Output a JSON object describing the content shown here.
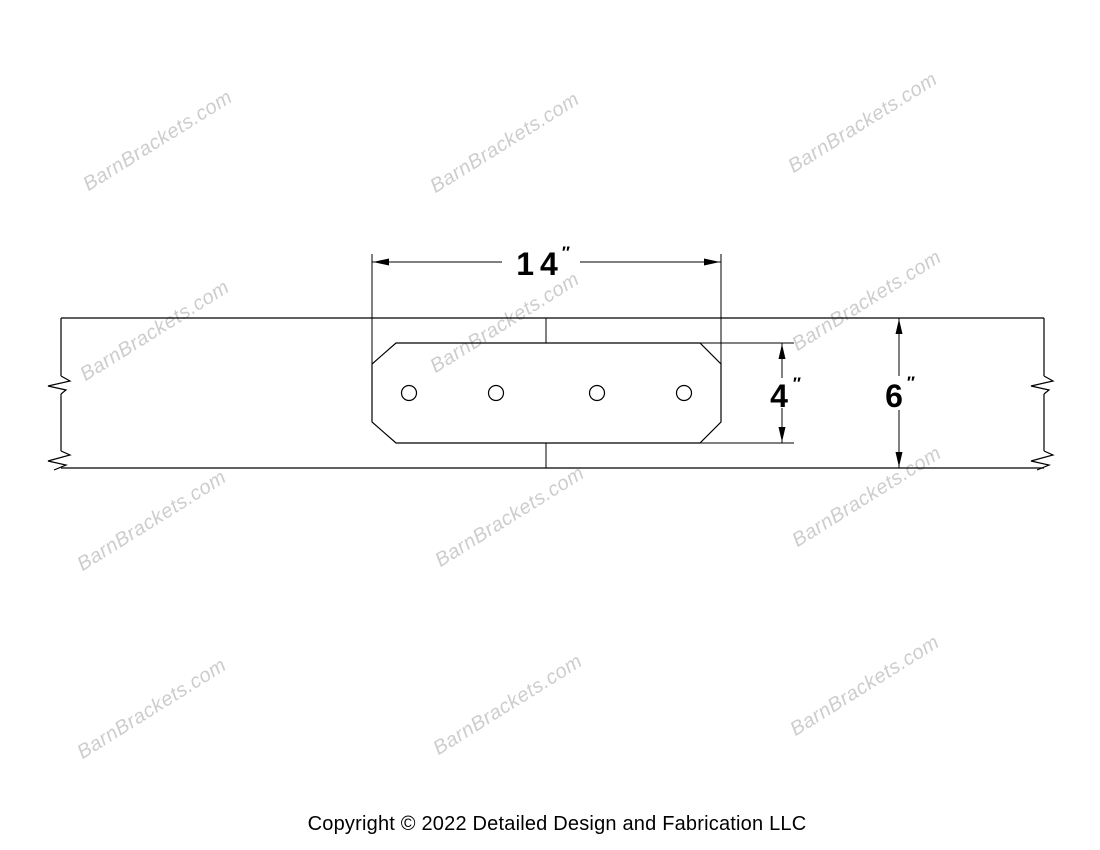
{
  "page": {
    "background": "#ffffff",
    "line_color": "#000000"
  },
  "watermark": {
    "text": "BarnBrackets.com",
    "color": "#cdcdcd"
  },
  "drawing": {
    "dimensions": {
      "plate_width": {
        "value": "14",
        "unit": "″"
      },
      "plate_height": {
        "value": "4",
        "unit": "″"
      },
      "beam_height": {
        "value": "6",
        "unit": "″"
      }
    },
    "plate_hole_count": 4
  },
  "footer": {
    "copyright": "Copyright © 2022 Detailed Design and Fabrication LLC"
  }
}
